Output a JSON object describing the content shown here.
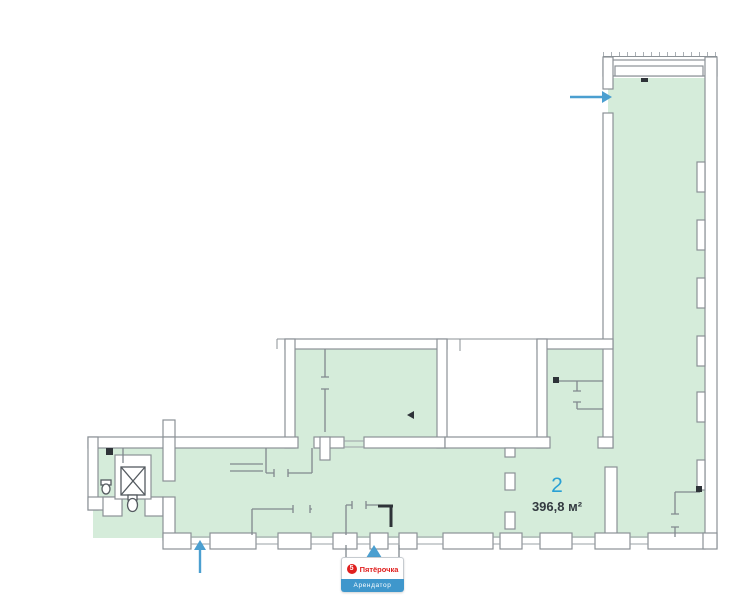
{
  "plan": {
    "unit_label": "2",
    "area_label": "396,8 м²",
    "colors": {
      "floor_fill": "#d5ecda",
      "wall_fill": "#ffffff",
      "wall_stroke": "#8b9196",
      "partition": "#81888e",
      "dark_detail": "#2e3338",
      "arrow": "#4b9fd0",
      "unit_label": "#29a0d4",
      "area_label": "#333a40"
    }
  },
  "tenant_badge": {
    "brand_name": "Пятёрочка",
    "logo_glyph": "5",
    "tenant_label": "Арендатор",
    "colors": {
      "brand_red": "#e0201f",
      "label_bg": "#3f97cc",
      "label_text": "#ffffff"
    }
  },
  "icons": {
    "entrance_arrow_right": "→",
    "entrance_arrow_up": "↑",
    "badge_pointer_up": "▲",
    "elevator_symbol": "⊠",
    "toilet_symbol": "toilet-bowl",
    "sink_symbol": "wash-sink"
  }
}
